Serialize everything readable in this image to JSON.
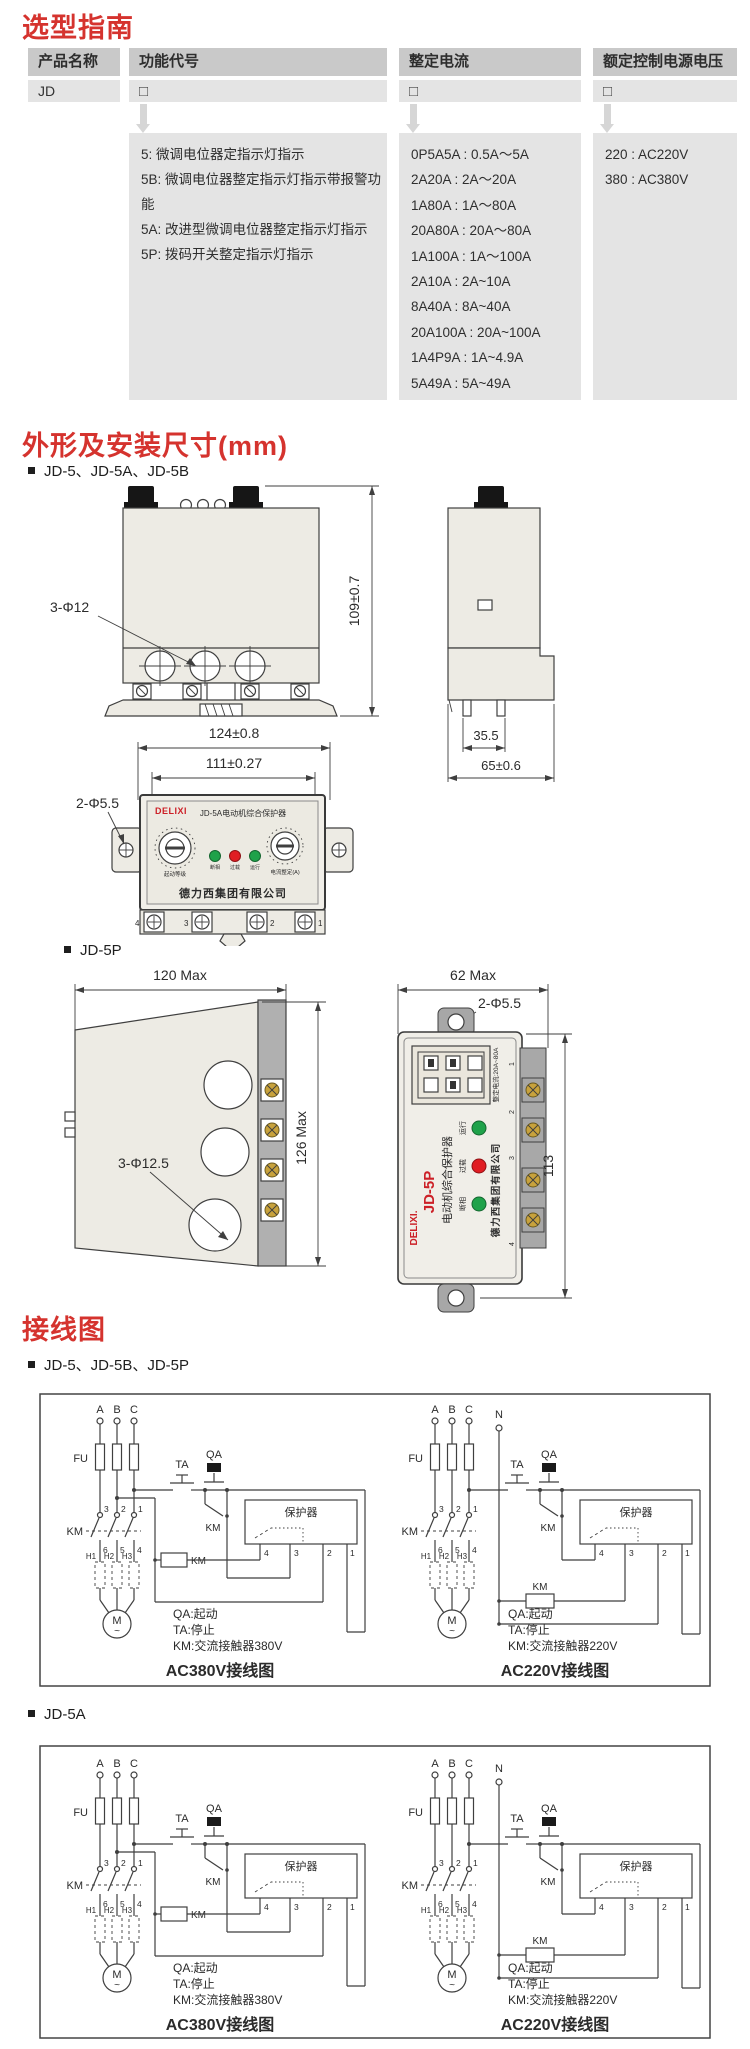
{
  "selection": {
    "title": "选型指南",
    "headers": [
      "产品名称",
      "功能代号",
      "整定电流",
      "额定控制电源电压"
    ],
    "product_name": "JD",
    "checkbox": "□",
    "function_codes": [
      "5: 微调电位器定指示灯指示",
      "5B: 微调电位器整定指示灯指示带报警功能",
      "5A: 改进型微调电位器整定指示灯指示",
      "5P: 拨码开关整定指示灯指示"
    ],
    "current_settings": [
      "0P5A5A : 0.5A～5A",
      "2A20A : 2A～20A",
      "1A80A : 1A～80A",
      "20A80A : 20A～80A",
      "1A100A : 1A～100A",
      "2A10A : 2A~10A",
      "8A40A : 8A~40A",
      "20A100A : 20A~100A",
      "1A4P9A : 1A~4.9A",
      "5A49A : 5A~49A"
    ],
    "voltage_codes": [
      "220 : AC220V",
      "380 : AC380V"
    ]
  },
  "dimensions": {
    "title": "外形及安装尺寸(mm)",
    "jd5_bullet": "JD-5、JD-5A、JD-5B",
    "jd5p_bullet": "JD-5P",
    "dims": {
      "height": "109±0.7",
      "holes3": "3-Φ12",
      "rail_inner": "35.5",
      "depth": "65±0.6",
      "width_outer": "124±0.8",
      "width_inner": "111±0.27",
      "mount2": "2-Φ5.5",
      "p_width": "120 Max",
      "p_height": "126 Max",
      "p_holes": "3-Φ12.5",
      "p_front_width": "62 Max",
      "p_mount": "2-Φ5.5",
      "p_front_height": "113"
    },
    "panel": {
      "brand": "DELIXI",
      "title": "JD-5A电动机综合保护器",
      "led_labels": [
        "断相",
        "过载",
        "运行"
      ],
      "knob_left_label": "起动等级",
      "knob_right_label": "电流整定(A)",
      "company": "德力西集团有限公司",
      "terminals": [
        "4",
        "3",
        "2",
        "1"
      ]
    },
    "panel5p": {
      "brand": "DELIXI.",
      "model": "JD-5P",
      "title": "电动机综合保护器",
      "current_range": "整定电流:20A~80A",
      "led_labels": [
        "运行",
        "过载",
        "断相"
      ],
      "company": "德力西集团有限公司",
      "terminals": [
        "1",
        "2",
        "3",
        "4"
      ]
    }
  },
  "wiring": {
    "title": "接线图",
    "group1_bullet": "JD-5、JD-5B、JD-5P",
    "group2_bullet": "JD-5A",
    "labels": {
      "phases": [
        "A",
        "B",
        "C"
      ],
      "neutral": "N",
      "fuse": "FU",
      "stop": "TA",
      "start": "QA",
      "contactor": "KM",
      "top_contacts": [
        "3",
        "2",
        "1"
      ],
      "bottom_contacts": [
        "6",
        "5",
        "4"
      ],
      "heaters": [
        "H1",
        "H2",
        "H3"
      ],
      "motor": "M",
      "motor_tilde": "~",
      "protector": "保护器",
      "protector_terms": [
        "4",
        "3",
        "2",
        "1"
      ]
    },
    "legend380": [
      "QA:起动",
      "TA:停止",
      "KM:交流接触器380V"
    ],
    "legend220": [
      "QA:起动",
      "TA:停止",
      "KM:交流接触器220V"
    ],
    "caption380": "AC380V接线图",
    "caption220": "AC220V接线图"
  }
}
